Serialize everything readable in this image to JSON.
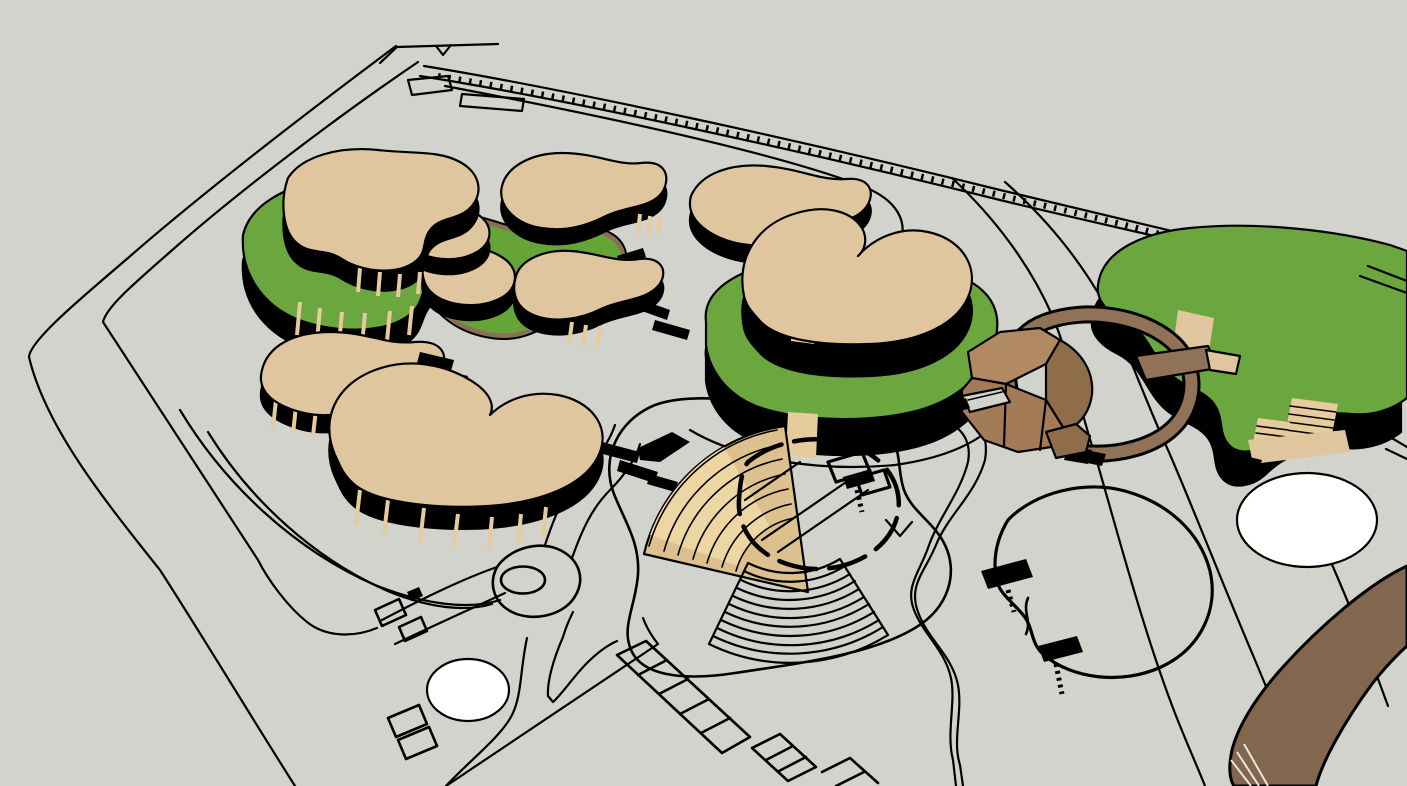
{
  "viewport": {
    "title": "site-master-plan-3d-view",
    "description": "Aerial axonometric hidden-line render of a landscape master plan: organic kidney-shaped buildings with tan roofs and dark glazed facades on green terraces, a central building on a green podium, an outdoor amphitheater with fan seating, a brown timber service pavilion with a looping elevated walkway, a large green-roof building, ponds, winding footpaths, parking rows and a perimeter road on a light gray ground plane."
  },
  "colors": {
    "ground": "#D2D3CD",
    "ink": "#000000",
    "roof_tan": "#E0C69E",
    "roof_tan_light": "#EBD7AE",
    "grass_green": "#6BA63E",
    "lawn_green": "#67A438",
    "ring_brown": "#8A6F58",
    "path_brown": "#8F7257",
    "block_light": "#B18962",
    "block_mid": "#A37C57",
    "block_dark": "#8F6C4A",
    "bridge_brown": "#82664E",
    "pond_white": "#FFFFFF",
    "amphi_top": "#DCC08E",
    "amphi_face": "#EDD6A4",
    "stripe_tan": "#E6CB9C"
  },
  "legend": {
    "ground": "open paved ground plane",
    "tan_buildings": "kidney-plan buildings, tan roofs over dark striped facades",
    "green_surfaces": "grass terraces, lawn pool and green roof",
    "amphitheater": "fan-shaped stepped seating with free-form stage",
    "brown_pavilion": "timber block pavilion with looping ramp walkway",
    "ponds": "two white ponds, one outlined lake with docks",
    "circulation": "perimeter road, hatched main road, winding footpaths, angled parking rows, roundabout",
    "bridge": "brown elevated roadway at the south-east corner"
  },
  "counts": {
    "tan_roof_buildings": 7,
    "green_roof_buildings": 1,
    "white_ponds": 2,
    "outlined_lakes": 1,
    "lawn_pools": 1,
    "parking_rows": 3
  }
}
